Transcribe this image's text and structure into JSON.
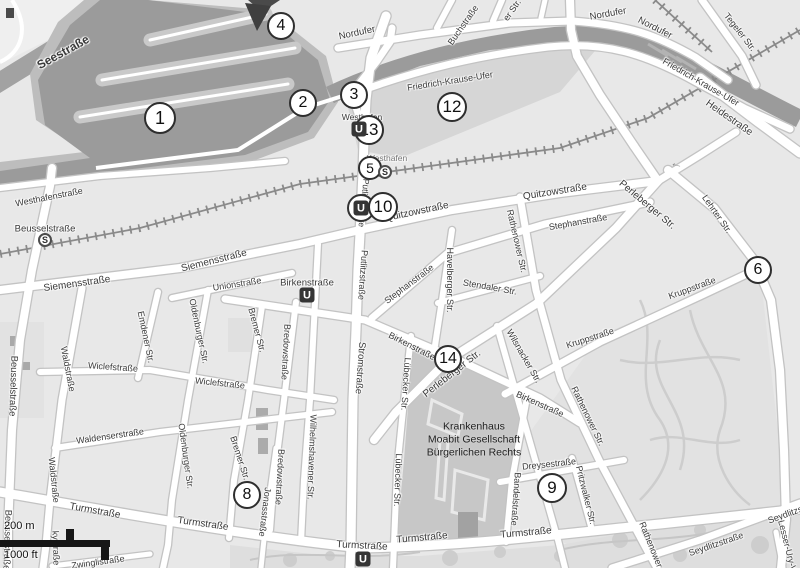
{
  "map": {
    "description": "Grayscale street map of Berlin Moabit / Westhafen with numbered location markers",
    "colors": {
      "land": "#e8e8e8",
      "water": "#9b9b9b",
      "harbor_rim": "#bdbdbd",
      "pier": "#c9c9c9",
      "road_fill": "#ffffff",
      "road_casing": "#c3c3c3",
      "railway": "#8a8a8a",
      "hospital_block": "#c7c7c7",
      "park": "#e2e2e2",
      "marker_stroke": "#2e2e2e",
      "seestrasse_band": "#a2a2a2",
      "flag_triangle": "#3f3f3f"
    },
    "icons": {
      "u_station": "U",
      "s_station": "S",
      "one_way_arrow": {
        "glyph": "←",
        "x": 677,
        "y": 163,
        "rot": 15
      }
    },
    "scalebar": {
      "metric_label": "200 m",
      "imperial_label": "1000 ft"
    },
    "hospital": {
      "x": 474,
      "y": 440,
      "lines": [
        "Krankenhaus",
        "Moabit Gesellschaft",
        "Bürgerlichen Rechts"
      ]
    },
    "markers": [
      {
        "n": "1",
        "x": 160,
        "y": 118,
        "rad": 16
      },
      {
        "n": "2",
        "x": 303,
        "y": 103,
        "rad": 14
      },
      {
        "n": "3",
        "x": 354,
        "y": 95,
        "rad": 14
      },
      {
        "n": "4",
        "x": 281,
        "y": 26,
        "rad": 14
      },
      {
        "n": "5",
        "x": 370,
        "y": 168,
        "rad": 12
      },
      {
        "n": "6",
        "x": 758,
        "y": 270,
        "rad": 14
      },
      {
        "n": "8",
        "x": 247,
        "y": 495,
        "rad": 14
      },
      {
        "n": "9",
        "x": 552,
        "y": 488,
        "rad": 15
      },
      {
        "n": "10",
        "x": 383,
        "y": 207,
        "rad": 15
      },
      {
        "n": "12",
        "x": 452,
        "y": 107,
        "rad": 15
      },
      {
        "n": "13",
        "x": 369,
        "y": 130,
        "rad": 15
      },
      {
        "n": "14",
        "x": 448,
        "y": 359,
        "rad": 14
      }
    ],
    "stations": [
      {
        "type": "U",
        "x": 307,
        "y": 295,
        "ring": false
      },
      {
        "type": "U",
        "x": 359,
        "y": 129,
        "ring": false
      },
      {
        "type": "U",
        "x": 361,
        "y": 208,
        "ring": true
      },
      {
        "type": "U",
        "x": 363,
        "y": 559,
        "ring": false
      },
      {
        "type": "S",
        "x": 45,
        "y": 240,
        "ring": false
      },
      {
        "type": "S",
        "x": 385,
        "y": 172,
        "ring": false
      }
    ],
    "street_labels": [
      {
        "t": "Seestraße",
        "x": 63,
        "y": 52,
        "r": -29,
        "fs": 12,
        "b": true
      },
      {
        "t": "Westhafenstraße",
        "x": 49,
        "y": 197,
        "r": -11,
        "fs": 9
      },
      {
        "t": "Beusselstraße",
        "x": 45,
        "y": 229,
        "r": 0,
        "fs": 9.5
      },
      {
        "t": "Beusselstraße",
        "x": 13,
        "y": 386,
        "r": 92,
        "fs": 9.5
      },
      {
        "t": "Beusselstraße",
        "x": 7,
        "y": 540,
        "r": 92,
        "fs": 9.5
      },
      {
        "t": "Siemensstraße",
        "x": 214,
        "y": 261,
        "r": -14,
        "fs": 10
      },
      {
        "t": "Siemensstraße",
        "x": 77,
        "y": 284,
        "r": -8,
        "fs": 10
      },
      {
        "t": "Unionstraße",
        "x": 237,
        "y": 284,
        "r": -9,
        "fs": 9
      },
      {
        "t": "Nordufer",
        "x": 357,
        "y": 33,
        "r": -12,
        "fs": 9.5
      },
      {
        "t": "Nordufer",
        "x": 608,
        "y": 14,
        "r": -10,
        "fs": 9.5
      },
      {
        "t": "Nordufer",
        "x": 655,
        "y": 28,
        "r": 27,
        "fs": 9.5
      },
      {
        "t": "Buchstraße",
        "x": 463,
        "y": 25,
        "r": -55,
        "fs": 9
      },
      {
        "t": "er Str.",
        "x": 512,
        "y": 10,
        "r": -55,
        "fs": 9
      },
      {
        "t": "Friedrich-Krause-Ufer",
        "x": 450,
        "y": 81,
        "r": -9,
        "fs": 9
      },
      {
        "t": "Friedrich-Krause-Ufer",
        "x": 701,
        "y": 82,
        "r": 30,
        "fs": 9
      },
      {
        "t": "Tegeler Str.",
        "x": 740,
        "y": 32,
        "r": 52,
        "fs": 9
      },
      {
        "t": "Heidestraße",
        "x": 729,
        "y": 118,
        "r": 35,
        "fs": 10
      },
      {
        "t": "Westhafen",
        "x": 362,
        "y": 117,
        "r": 0,
        "fs": 8.5
      },
      {
        "t": "Westhafen",
        "x": 387,
        "y": 158,
        "r": 0,
        "fs": 8.5,
        "c": "#767676"
      },
      {
        "t": "Putlitzbrücke",
        "x": 364,
        "y": 203,
        "r": 96,
        "fs": 8.5
      },
      {
        "t": "Quitzowstraße",
        "x": 417,
        "y": 212,
        "r": -12,
        "fs": 10
      },
      {
        "t": "Quitzowstraße",
        "x": 555,
        "y": 192,
        "r": -9,
        "fs": 10
      },
      {
        "t": "Stephanstraße",
        "x": 409,
        "y": 284,
        "r": -37,
        "fs": 9
      },
      {
        "t": "Stephanstraße",
        "x": 578,
        "y": 222,
        "r": -10,
        "fs": 9
      },
      {
        "t": "Perleberger Str.",
        "x": 647,
        "y": 205,
        "r": 40,
        "fs": 10
      },
      {
        "t": "Perleberger Str.",
        "x": 452,
        "y": 374,
        "r": -38,
        "fs": 10
      },
      {
        "t": "Lehrter Str.",
        "x": 717,
        "y": 214,
        "r": 55,
        "fs": 9
      },
      {
        "t": "Rathenower Str.",
        "x": 517,
        "y": 241,
        "r": 77,
        "fs": 9
      },
      {
        "t": "Stendaler Str.",
        "x": 490,
        "y": 287,
        "r": 10,
        "fs": 9
      },
      {
        "t": "Havelberger Str.",
        "x": 450,
        "y": 280,
        "r": 90,
        "fs": 9
      },
      {
        "t": "Kruppstraße",
        "x": 692,
        "y": 288,
        "r": -20,
        "fs": 9
      },
      {
        "t": "Kruppstraße",
        "x": 590,
        "y": 338,
        "r": -18,
        "fs": 9
      },
      {
        "t": "Wilsnacker Str.",
        "x": 524,
        "y": 356,
        "r": 60,
        "fs": 9
      },
      {
        "t": "Birkenstraße",
        "x": 307,
        "y": 283,
        "r": 0,
        "fs": 9.5
      },
      {
        "t": "Birkenstraße",
        "x": 412,
        "y": 346,
        "r": 27,
        "fs": 9
      },
      {
        "t": "Birkenstraße",
        "x": 540,
        "y": 404,
        "r": 24,
        "fs": 9
      },
      {
        "t": "Stromstraße",
        "x": 360,
        "y": 368,
        "r": 94,
        "fs": 9.5
      },
      {
        "t": "Putlitzstraße",
        "x": 363,
        "y": 275,
        "r": 94,
        "fs": 9
      },
      {
        "t": "Lübecker Str.",
        "x": 406,
        "y": 384,
        "r": 94,
        "fs": 9
      },
      {
        "t": "Lübecker Str.",
        "x": 398,
        "y": 480,
        "r": 92,
        "fs": 9
      },
      {
        "t": "Bredowstraße",
        "x": 286,
        "y": 352,
        "r": 93,
        "fs": 9
      },
      {
        "t": "Bredowstraße",
        "x": 280,
        "y": 477,
        "r": 93,
        "fs": 9
      },
      {
        "t": "Bremer Str.",
        "x": 257,
        "y": 330,
        "r": 75,
        "fs": 9
      },
      {
        "t": "Bremer Str.",
        "x": 240,
        "y": 458,
        "r": 72,
        "fs": 9
      },
      {
        "t": "Jonasstraße",
        "x": 265,
        "y": 512,
        "r": 97,
        "fs": 9
      },
      {
        "t": "Wilhelmshavener Str.",
        "x": 312,
        "y": 457,
        "r": 92,
        "fs": 9
      },
      {
        "t": "Oldenburger Str.",
        "x": 199,
        "y": 331,
        "r": 78,
        "fs": 9
      },
      {
        "t": "Oldenburger Str.",
        "x": 186,
        "y": 456,
        "r": 82,
        "fs": 9
      },
      {
        "t": "Emdener Str.",
        "x": 146,
        "y": 337,
        "r": 78,
        "fs": 9
      },
      {
        "t": "Waldstraße",
        "x": 68,
        "y": 369,
        "r": 79,
        "fs": 9
      },
      {
        "t": "Waldstraße",
        "x": 54,
        "y": 480,
        "r": 84,
        "fs": 9
      },
      {
        "t": "Wiclefstraße",
        "x": 113,
        "y": 367,
        "r": 4,
        "fs": 9
      },
      {
        "t": "Wiclefstraße",
        "x": 220,
        "y": 383,
        "r": 6,
        "fs": 9
      },
      {
        "t": "Waldenserstraße",
        "x": 110,
        "y": 436,
        "r": -8,
        "fs": 9
      },
      {
        "t": "Turmstraße",
        "x": 95,
        "y": 511,
        "r": 10,
        "fs": 10
      },
      {
        "t": "Turmstraße",
        "x": 203,
        "y": 524,
        "r": 8,
        "fs": 10
      },
      {
        "t": "Turmstraße",
        "x": 362,
        "y": 546,
        "r": 3,
        "fs": 10
      },
      {
        "t": "Turmstraße",
        "x": 422,
        "y": 538,
        "r": -5,
        "fs": 10
      },
      {
        "t": "Turmstraße",
        "x": 526,
        "y": 533,
        "r": -5,
        "fs": 10
      },
      {
        "t": "Dreysestraße",
        "x": 549,
        "y": 464,
        "r": -6,
        "fs": 9
      },
      {
        "t": "Bandelstraße",
        "x": 516,
        "y": 499,
        "r": 94,
        "fs": 9
      },
      {
        "t": "Rathenower Str.",
        "x": 588,
        "y": 416,
        "r": 64,
        "fs": 9
      },
      {
        "t": "Rathenower Str.",
        "x": 654,
        "y": 552,
        "r": 68,
        "fs": 9
      },
      {
        "t": "Pritzwalker Str.",
        "x": 586,
        "y": 495,
        "r": 76,
        "fs": 9
      },
      {
        "t": "Seydlitzstraße",
        "x": 716,
        "y": 544,
        "r": -19,
        "fs": 9
      },
      {
        "t": "Seydlitzstraße",
        "x": 795,
        "y": 511,
        "r": -20,
        "fs": 9
      },
      {
        "t": "Lesser-Ury-Weg",
        "x": 789,
        "y": 552,
        "r": 76,
        "fs": 9
      },
      {
        "t": "Zwinglistraße",
        "x": 98,
        "y": 562,
        "r": -8,
        "fs": 9
      },
      {
        "t": "kystraße",
        "x": 56,
        "y": 548,
        "r": 88,
        "fs": 9
      }
    ]
  }
}
